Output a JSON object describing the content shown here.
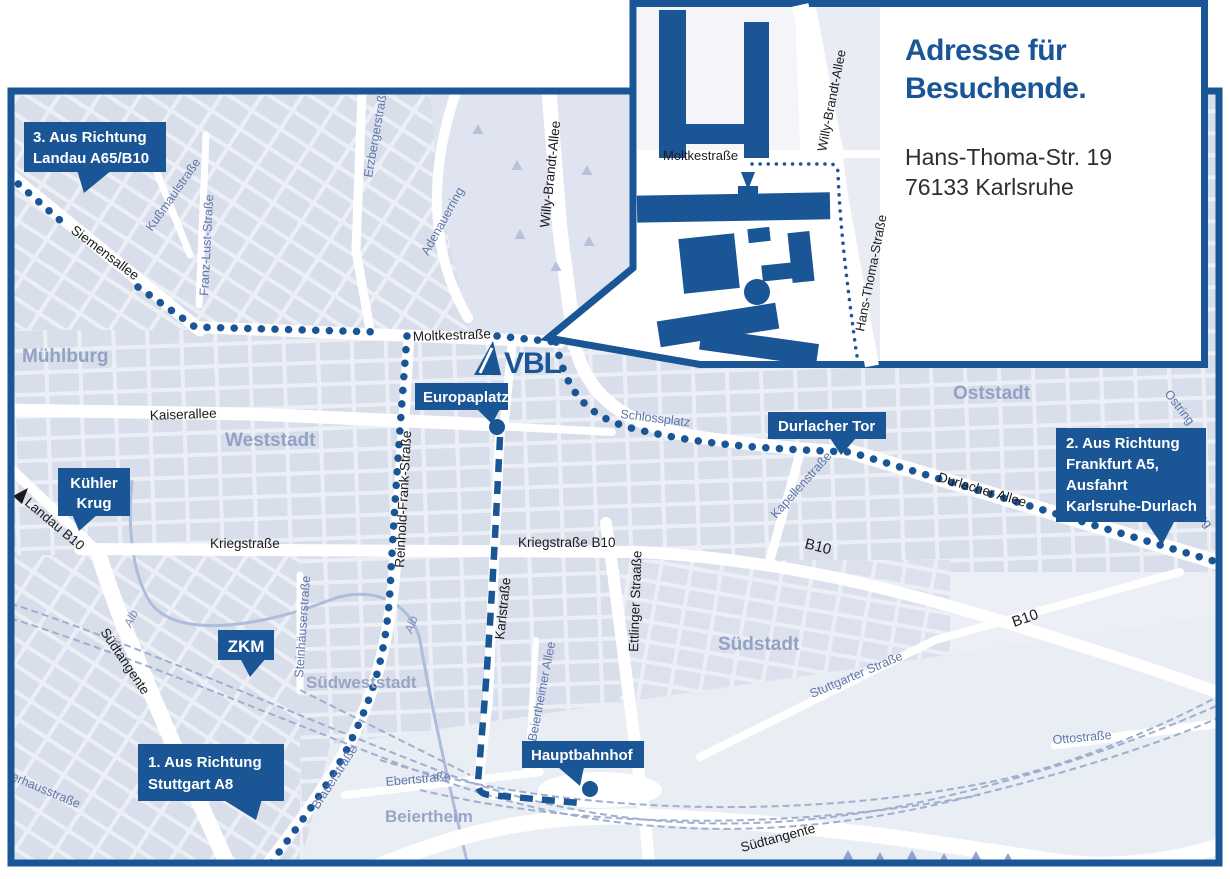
{
  "colors": {
    "brand_blue": "#1a5596",
    "map_background": "#eceff5",
    "city_block": "#d9deeb",
    "park": "#dfe4f0",
    "street_white": "#ffffff",
    "railway": "#9fafd0",
    "street_label_blue": "#6076a9",
    "street_label_black": "#1b1b1d",
    "district_label": "#93a1c4"
  },
  "logo": {
    "text": "VBL"
  },
  "inset": {
    "title_line1": "Adresse für",
    "title_line2": "Besuchende.",
    "address_line1": "Hans-Thoma-Str. 19",
    "address_line2": "76133 Karlsruhe",
    "moltkestrasse": "Moltkestraße",
    "willy_brandt_allee": "Willy-Brandt-Allee",
    "hans_thoma_strasse": "Hans-Thoma-Straße"
  },
  "callouts": {
    "route3_line1": "3. Aus Richtung",
    "route3_line2": "Landau A65/B10",
    "route2_line1": "2. Aus Richtung",
    "route2_line2": "Frankfurt A5,",
    "route2_line3": "Ausfahrt",
    "route2_line4": "Karlsruhe-Durlach",
    "route1_line1": "1. Aus Richtung",
    "route1_line2": "Stuttgart A8",
    "kuehler_krug_line1": "Kühler",
    "kuehler_krug_line2": "Krug",
    "zkm": "ZKM",
    "europaplatz": "Europaplatz",
    "durlacher_tor": "Durlacher Tor",
    "hauptbahnhof": "Hauptbahnhof"
  },
  "districts": {
    "muehlburg": "Mühlburg",
    "weststadt": "Weststadt",
    "oststadt": "Oststadt",
    "suedstadt": "Südstadt",
    "suedweststadt": "Südweststadt",
    "beiertheim": "Beiertheim"
  },
  "streets": {
    "siemensallee": "Siemensallee",
    "kussmaulstrasse": "Kußmaulstraße",
    "franz_lust_strasse": "Franz-Lust-Straße",
    "erzbergerstrasse": "Erzbergerstraße",
    "adenauerring": "Adenauerring",
    "willy_brandt_allee": "Willy-Brandt-Allee",
    "moltkestrasse": "Moltkestraße",
    "kaiserallee": "Kaiserallee",
    "reinhold_frank_strasse": "Reinhold-Frank-Straße",
    "kriegstrasse": "Kriegstraße",
    "kriegstrasse_b10": "Kriegstraße B10",
    "karlstrasse": "Karlstraße",
    "ettlinger_strasse": "Ettlinger Straaße",
    "schlossplatz": "Schlossplatz",
    "kapellenstrasse": "Kapellenstraße",
    "durlacher_allee": "Durlacher Allee",
    "b10": "B10",
    "ostring": "Ostring",
    "stuttgarter_strasse": "Stuttgarter Straße",
    "suedtangente": "Südtangente",
    "ottostrasse": "Ottostraße",
    "brauerstrasse": "Brauerstraße",
    "ebertstrasse": "Ebertstraße",
    "steinhaeuserstrasse": "Steinhäuserstraße",
    "beiertheimer_allee": "Beiertheimer Allee",
    "alb": "Alb",
    "pulverhausstrasse": "Pulverhausstraße",
    "landau_b10": "Landau B10"
  }
}
